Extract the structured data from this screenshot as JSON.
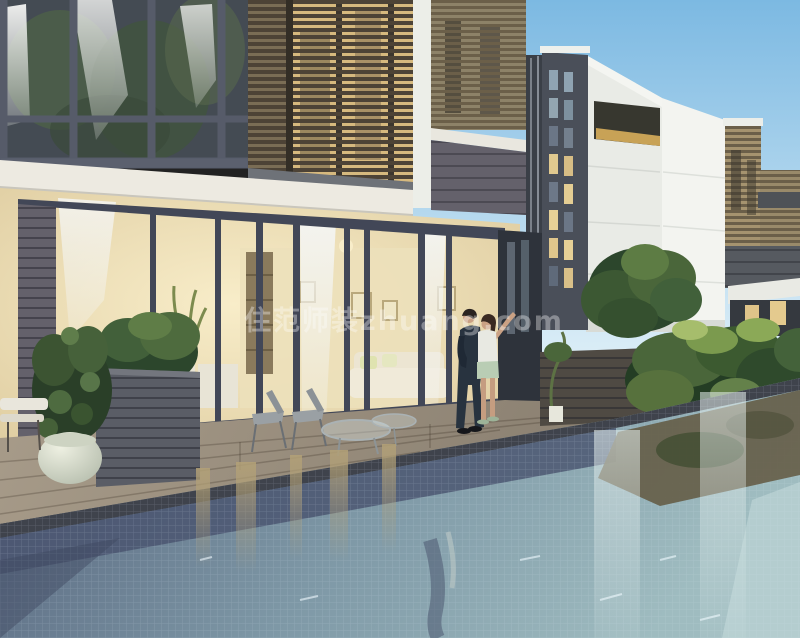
{
  "meta": {
    "type": "architectural-rendering",
    "subject": "Modern villa townhouses with wooden louver facades, lit interiors, deck and mosaic swimming pool at dusk; a couple stands on the pool deck",
    "width": 800,
    "height": 638
  },
  "watermark": {
    "text": "住范师装zhuang.com",
    "opacity": "0.35"
  },
  "palette": {
    "sky_top": "#7cb9e2",
    "sky_low": "#dceef7",
    "white_building": "#e9ebe6",
    "white_building_bright": "#f3f4f0",
    "tower_gray": "#4a4f59",
    "fascia_white": "#edeae1",
    "louver_glow": "#d6b97e",
    "louver_slat": "#4d4336",
    "louver_tan": "#b5a988",
    "frame_dark": "#424757",
    "glass_dark": "#444b53",
    "curtain_white": "#f2f4f4",
    "interior_warm": "#f3e6bf",
    "interior_wall": "#ece0ba",
    "siding_gray": "#64616b",
    "deck_light": "#a89c8a",
    "deck_dark": "#82786a",
    "coping_dark": "#3f434c",
    "planter_gray": "#5a5d66",
    "wood_wall": "#4f4a43",
    "pot_cream": "#eef0e2",
    "foliage_dark": "#2c462c",
    "foliage_mid": "#4a663a",
    "foliage_light": "#7b9a4e",
    "pool_left": "#53607a",
    "pool_mid": "#7e98a6",
    "pool_right": "#9fbcc0",
    "pool_band": "#49536e",
    "reflection_warm": "#b3a177",
    "reflection_olive": "#655d47",
    "suit_navy": "#28333f",
    "skin": "#caa184",
    "shorts_mint": "#b9cdb4",
    "top_white": "#e8e9e2",
    "watermark_color": "#ffffff"
  }
}
